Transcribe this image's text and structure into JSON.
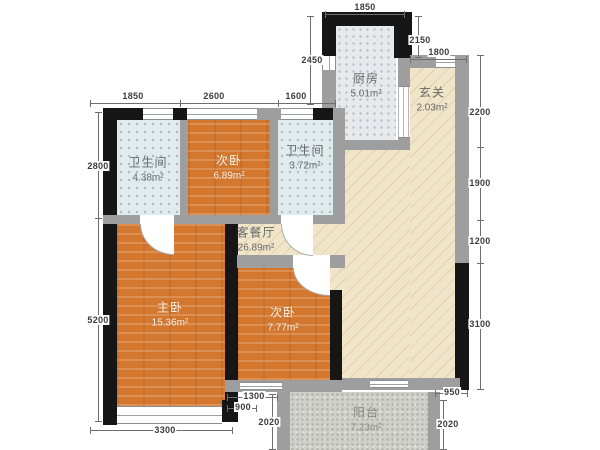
{
  "plan_title": "3-room residential floor plan",
  "rooms": {
    "kitchen": {
      "name": "厨房",
      "area": "5.01m²"
    },
    "foyer": {
      "name": "玄关",
      "area": "2.03m²"
    },
    "bath1": {
      "name": "卫生间",
      "area": "4.38m²"
    },
    "bed_top": {
      "name": "次卧",
      "area": "6.89m²"
    },
    "bath2": {
      "name": "卫生间",
      "area": "3.72m²"
    },
    "living": {
      "name": "客餐厅",
      "area": "26.89m²"
    },
    "master": {
      "name": "主卧",
      "area": "15.36m²"
    },
    "bed_mid": {
      "name": "次卧",
      "area": "7.77m²"
    },
    "balcony": {
      "name": "阳台",
      "area": "7.23m²"
    }
  },
  "dims": {
    "kitchen_top": "1850",
    "kitchen_left": "2450",
    "kitchen_right": "2150",
    "foyer_top": "1800",
    "row2": [
      "1850",
      "2600",
      "1600"
    ],
    "left": [
      "2800",
      "5200"
    ],
    "right": [
      "2200",
      "1900",
      "1200",
      "3100"
    ],
    "master_bottom": "3300",
    "bed_mid_bottom_a": "1300",
    "bed_mid_bottom_b": "900",
    "balcony_left": "2020",
    "right_notch": "950",
    "balcony_right": "2020"
  },
  "colors": {
    "wood_floor": "#d4782f",
    "living_floor": "#f1e5c9",
    "kitchen_floor": "#e7eaec",
    "bath_floor": "#e0ebee",
    "balcony_floor": "#d0d0ca",
    "bearing_wall": "#161616",
    "partition_wall": "#9e9e9e"
  }
}
